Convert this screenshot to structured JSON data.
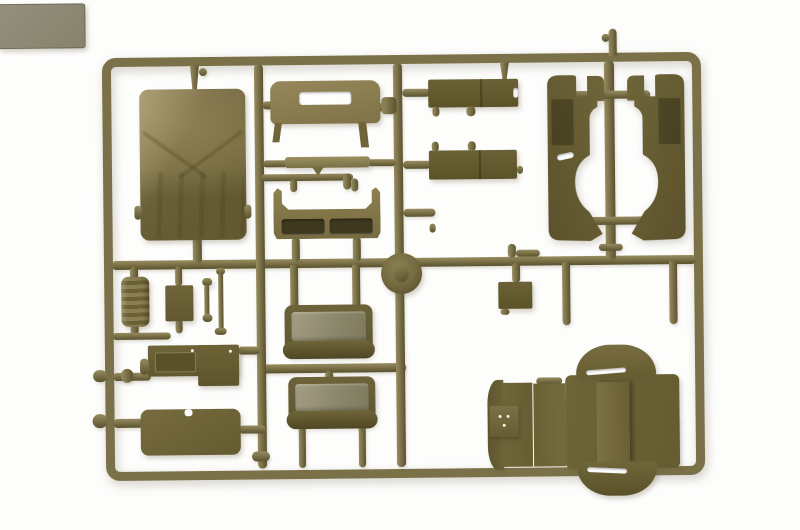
{
  "meta": {
    "title": "Olive drab model-kit sprue photograph",
    "description": "Product photo of an injection-moulded olive-drab plastic sprue (parts tree) for a military truck model kit, shot on a plain white background. A rectangular runner frame holds body panels, seats, boxes and fittings."
  },
  "colors": {
    "background": "#fdfdfc",
    "runner": "#7b7148",
    "runner_hi": "#978c60",
    "runner_lo": "#5a522e",
    "dark": "#5c5328",
    "mid": "#6b6136",
    "mid2": "#746a3e",
    "light": "#8b7d50",
    "canvas_hi": "#98895d",
    "canvas_lo": "#6a6036",
    "gray": "#93917d",
    "cushion": "#a39d85",
    "opening": "#3e381e"
  },
  "sprue": {
    "frame_label": "rectangular runner frame",
    "parts": [
      {
        "id": "canvas-tilt",
        "label": "Canvas tilt cover"
      },
      {
        "id": "rear-panel",
        "label": "Cab rear panel with window cutout"
      },
      {
        "id": "header-strip",
        "label": "Thin header strip"
      },
      {
        "id": "cowl-panel",
        "label": "Cowl panel with twin openings"
      },
      {
        "id": "roof-disc",
        "label": "Round disc"
      },
      {
        "id": "stowage-box-a",
        "label": "Stowage box"
      },
      {
        "id": "stowage-box-b",
        "label": "Stowage box"
      },
      {
        "id": "floor-panel",
        "label": "Flat floor panel"
      },
      {
        "id": "side-panel-left",
        "label": "Cab side panel left"
      },
      {
        "id": "side-panel-right",
        "label": "Cab side panel right"
      },
      {
        "id": "canister",
        "label": "Ribbed canister"
      },
      {
        "id": "small-plate",
        "label": "Small plate"
      },
      {
        "id": "linkage-rod-a",
        "label": "Small linkage rod"
      },
      {
        "id": "linkage-rod-b",
        "label": "Small linkage rod"
      },
      {
        "id": "dashboard",
        "label": "Dashboard panel"
      },
      {
        "id": "lower-panel",
        "label": "Flat lower panel"
      },
      {
        "id": "bench-seat-a",
        "label": "Bench seat"
      },
      {
        "id": "bench-seat-b",
        "label": "Bench seat"
      },
      {
        "id": "small-box",
        "label": "Small box"
      },
      {
        "id": "cab-assembly",
        "label": "Cab roof and fender assembly"
      }
    ]
  }
}
